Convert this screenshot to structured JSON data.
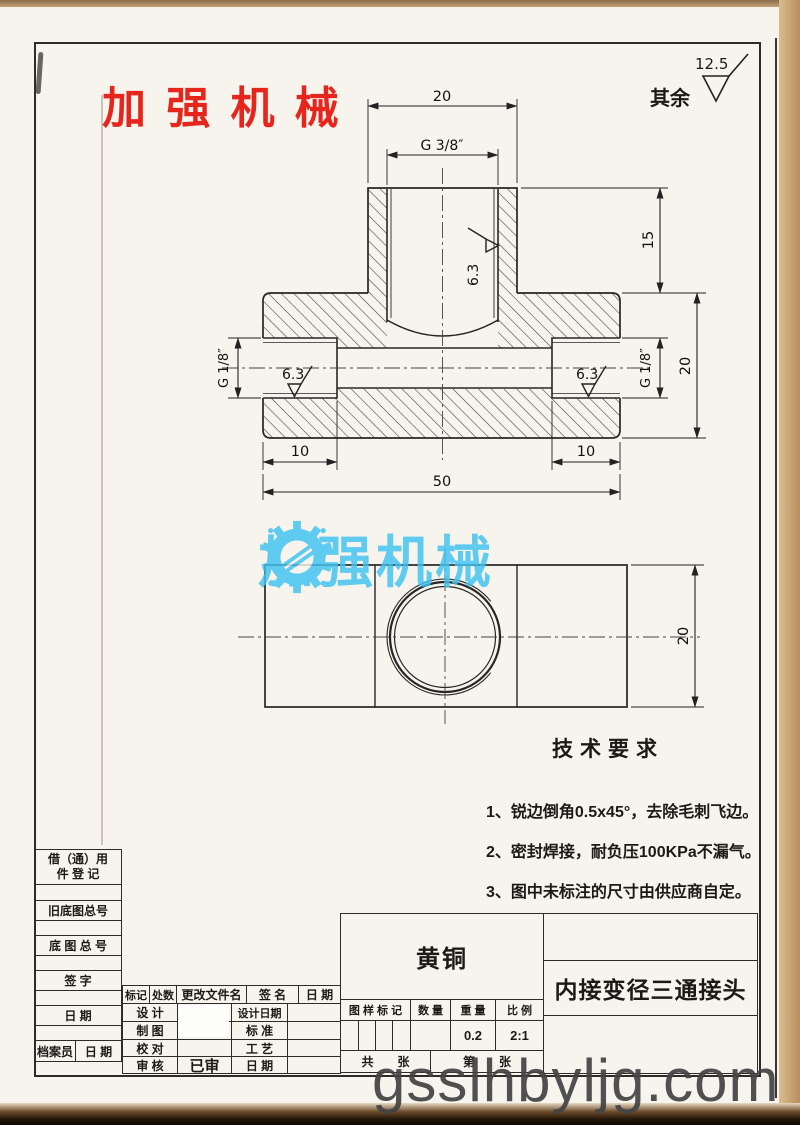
{
  "stamp": {
    "text": "加 强 机 械",
    "color": "#e6251d"
  },
  "surface_note": {
    "label": "其余",
    "value": "12.5"
  },
  "logo_watermark": {
    "text": "加强机械",
    "color": "#3fc3f2"
  },
  "site_watermark": {
    "text": "gsslhbyljg.com"
  },
  "drawing": {
    "dims": {
      "top_width": "20",
      "top_thread": "G 3/8″",
      "branch_height": "15",
      "body_height": "20",
      "side_thread": "G 1/8″",
      "finish": "6.3",
      "bore_depth": "10",
      "total_length": "50",
      "bottom_height": "20"
    }
  },
  "tech_req": {
    "title": "技术要求",
    "items": [
      "1、锐边倒角0.5x45°，去除毛刺飞边。",
      "2、密封焊接，耐负压100KPa不漏气。",
      "3、图中未标注的尺寸由供应商自定。"
    ]
  },
  "title_block": {
    "left": {
      "borrow_line1": "借（通）用",
      "borrow_line2": "件 登 记",
      "old_base_no": "旧底图总号",
      "base_no": "底 图 总 号",
      "signature": "签  字",
      "date": "日  期",
      "archivist": "档案员",
      "archivist_date": "日 期"
    },
    "revision": {
      "mark": "标记",
      "count": "处数",
      "file": "更改文件名",
      "sign": "签  名",
      "date": "日 期"
    },
    "roles": {
      "design": "设 计",
      "design_date": "设计日期",
      "draft": "制 图",
      "standard": "标 准",
      "check": "校 对",
      "process": "工 艺",
      "audit": "审 核",
      "audited": "已审",
      "date": "日 期"
    },
    "material": "黄铜",
    "part_name": "内接变径三通接头",
    "spec": {
      "mark": "图 样 标 记",
      "qty": "数 量",
      "weight": "重 量",
      "scale": "比 例",
      "weight_value": "0.2",
      "scale_value": "2:1"
    },
    "sheets": {
      "total": "共　　张",
      "page": "第　　张"
    }
  }
}
